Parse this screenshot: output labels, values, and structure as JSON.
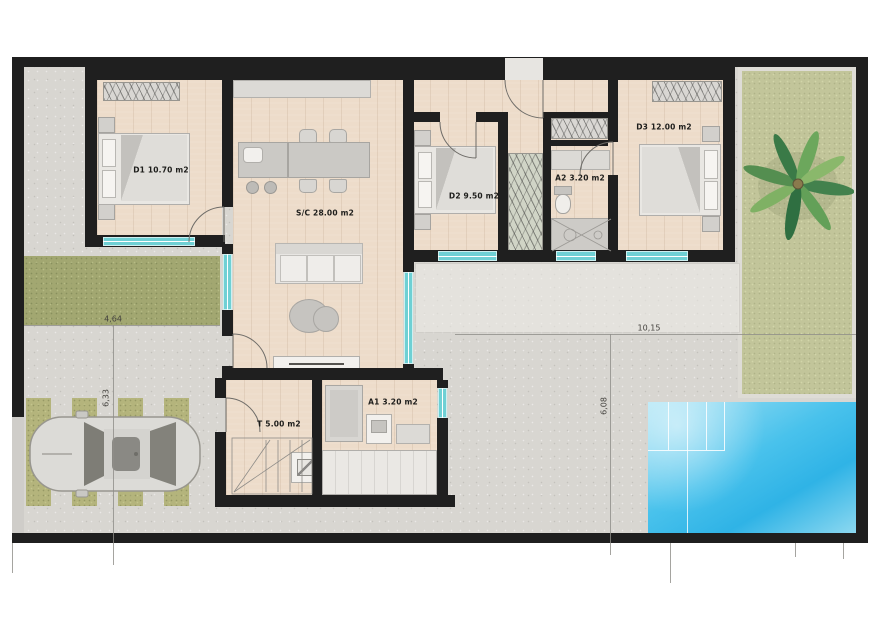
{
  "plan": {
    "type": "residential-floor-plan",
    "rooms": {
      "d1": {
        "label": "D1 10.70 m2"
      },
      "sc": {
        "label": "S/C 28.00 m2"
      },
      "d2": {
        "label": "D2 9.50 m2"
      },
      "a2": {
        "label": "A2 3.20 m2"
      },
      "d3": {
        "label": "D3 12.00 m2"
      },
      "t": {
        "label": "T 5.00 m2"
      },
      "a1": {
        "label": "A1 3.20 m2"
      }
    },
    "dimensions": {
      "lawn_width": "4,64",
      "driveway_depth": "6,33",
      "terrace_width": "10,15",
      "pool_terrace_depth": "6,08"
    },
    "features": [
      "swimming-pool",
      "palm-garden",
      "driveway-with-car",
      "front-lawn",
      "rear-terrace",
      "wood-deck"
    ],
    "colors": {
      "wall": "#1f1f1f",
      "wood_floor": "#eddcca",
      "window": "#6fd0d4",
      "pool": "#3ab9e8",
      "lawn": "#a2a771",
      "garden": "#c2c59a",
      "concrete": "#d8d6d1",
      "furniture": "#d3d1cd"
    }
  }
}
